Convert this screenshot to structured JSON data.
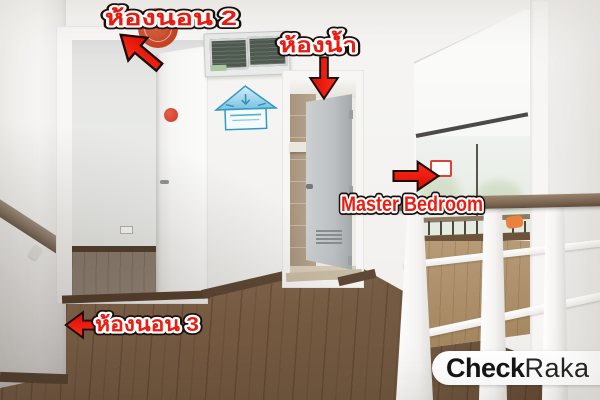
{
  "annotations": {
    "bedroom2_label": "ห้องนอน 2",
    "bathroom_label": "ห้องน้ำ",
    "master_bedroom_label": "Master Bedroom",
    "bedroom3_label": "ห้องนอน 3",
    "label_color": "#ee1b10",
    "label_outline_color": "#ffffff",
    "arrow_color": "#ee150b",
    "arrow_outline_color": "#1d0d09"
  },
  "watermark": {
    "text_bold": "Check",
    "text_regular": "Raka",
    "full": "CheckRaka",
    "background": "#ffffff",
    "text_color": "#151515"
  },
  "scene": {
    "colors": {
      "wall": "#f4f3f1",
      "hallway_floor": "#7c6148",
      "bedroom2_floor": "#8f8172",
      "baseboard": "#5a4431",
      "bathroom_tile": "#b4a28b",
      "bathroom_door": "#bcc0c2",
      "railing_wood": "#806b55",
      "railing_white": "#f6f5f3",
      "breaker_window": "#4e5a50",
      "insulation_sticker_blue": "#3399c2"
    }
  }
}
